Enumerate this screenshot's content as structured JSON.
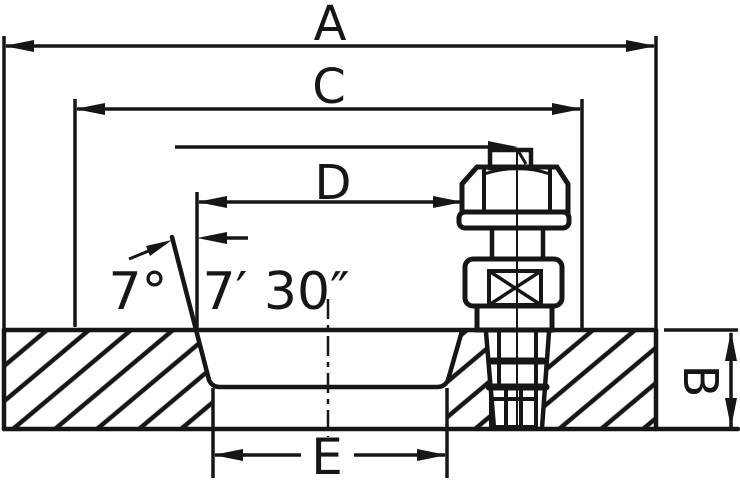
{
  "drawing": {
    "background_color": "#ffffff",
    "line_color": "#161616",
    "labels": {
      "dim_a": "A",
      "dim_c": "C",
      "dim_d": "D",
      "dim_e": "E",
      "dim_b": "B",
      "angle_degrees": "7°",
      "angle_minutes_seconds": "7′ 30″"
    }
  }
}
